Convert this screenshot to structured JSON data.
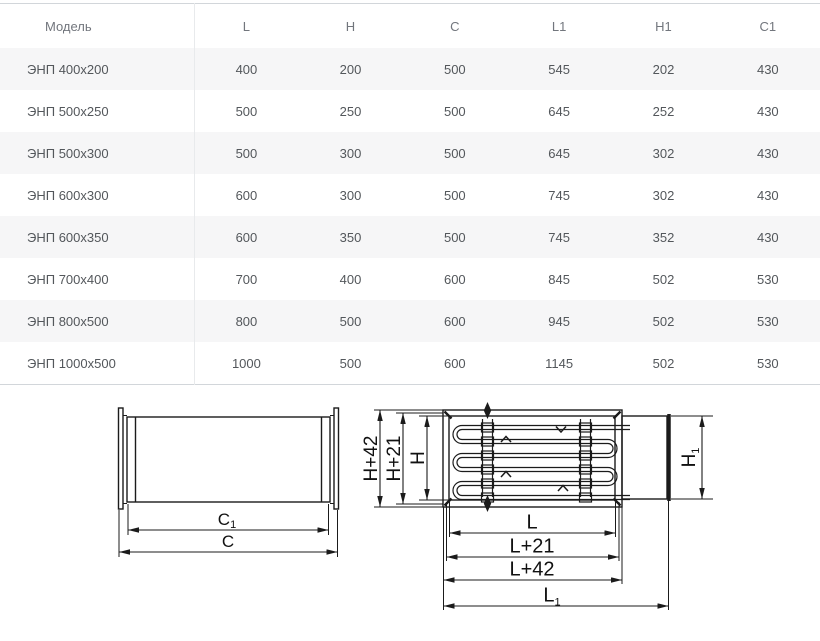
{
  "table": {
    "columns": [
      "Модель",
      "L",
      "H",
      "C",
      "L1",
      "H1",
      "C1"
    ],
    "rows": [
      [
        "ЭНП 400x200",
        "400",
        "200",
        "500",
        "545",
        "202",
        "430"
      ],
      [
        "ЭНП 500x250",
        "500",
        "250",
        "500",
        "645",
        "252",
        "430"
      ],
      [
        "ЭНП 500x300",
        "500",
        "300",
        "500",
        "645",
        "302",
        "430"
      ],
      [
        "ЭНП 600x300",
        "600",
        "300",
        "500",
        "745",
        "302",
        "430"
      ],
      [
        "ЭНП 600x350",
        "600",
        "350",
        "500",
        "745",
        "352",
        "430"
      ],
      [
        "ЭНП 700x400",
        "700",
        "400",
        "600",
        "845",
        "502",
        "530"
      ],
      [
        "ЭНП 800x500",
        "800",
        "500",
        "600",
        "945",
        "502",
        "530"
      ],
      [
        "ЭНП 1000x500",
        "1000",
        "500",
        "600",
        "1145",
        "502",
        "530"
      ]
    ]
  },
  "diagram": {
    "labels": {
      "c": "C",
      "c1_base": "C",
      "c1_sub": "1",
      "h42": "H+42",
      "h21": "H+21",
      "h": "H",
      "h1_base": "H",
      "h1_sub": "1",
      "l": "L",
      "l21": "L+21",
      "l42": "L+42",
      "l1_base": "L",
      "l1_sub": "1"
    }
  },
  "colors": {
    "background": "#ffffff",
    "table_border": "#d2d6da",
    "table_divider": "#e8eaec",
    "row_stripe": "#f6f6f7",
    "header_text": "#72767d",
    "cell_text": "#53575b",
    "diagram_line": "#1b1b1b"
  }
}
